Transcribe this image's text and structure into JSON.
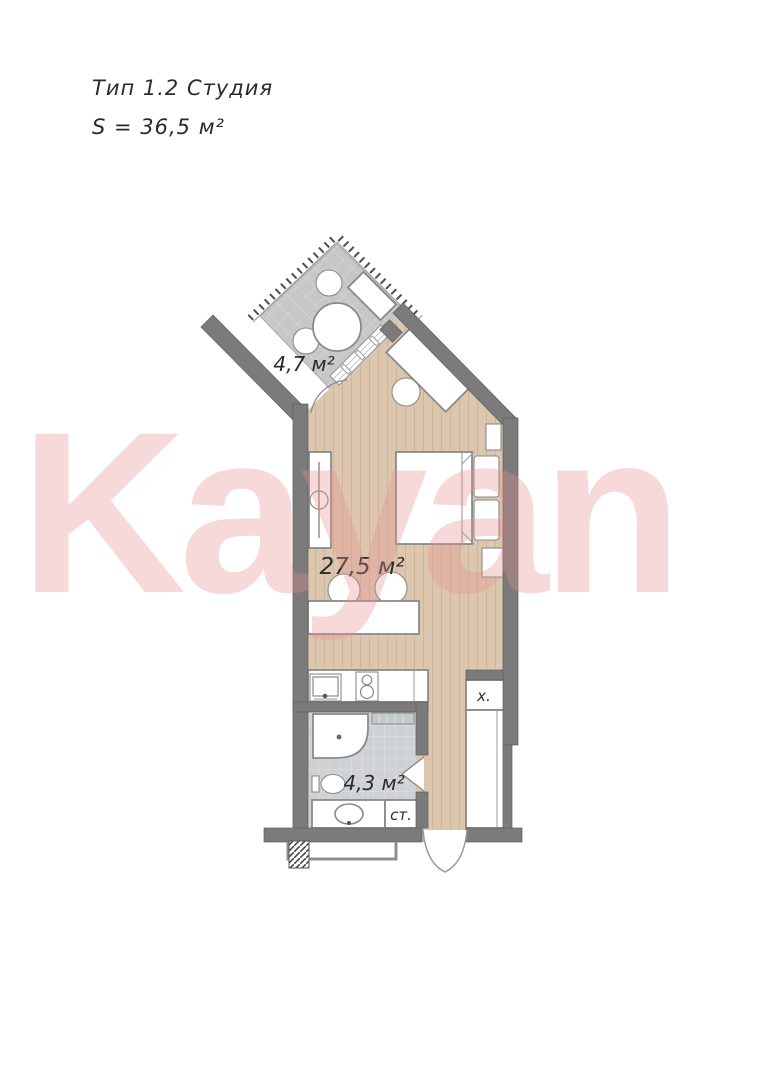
{
  "header": {
    "type_label": "Тип 1.2 Студия",
    "area_label": "S = 36,5 м²"
  },
  "watermark": {
    "text": "Kayan"
  },
  "rooms": {
    "balcony": {
      "area_label": "4,7 м²"
    },
    "studio": {
      "area_label": "27,5 м²"
    },
    "bathroom": {
      "area_label": "4,3 м²"
    },
    "closet": {
      "label": "х."
    },
    "washer": {
      "label": "ст."
    }
  },
  "colors": {
    "wall": "#7b7b7b",
    "wall_edge": "#5e5e5e",
    "floor": "#dcc7ae",
    "floor_line": "#ccb79c",
    "balcony_tile": "#c7c7c7",
    "balcony_tile_line": "#dadada",
    "bath_tile": "#ced2d5",
    "bath_tile_line": "#e0e3e5",
    "furniture_stroke": "#8a8a8a",
    "ink": "#2b2b2b",
    "watermark": "#e78f92"
  }
}
